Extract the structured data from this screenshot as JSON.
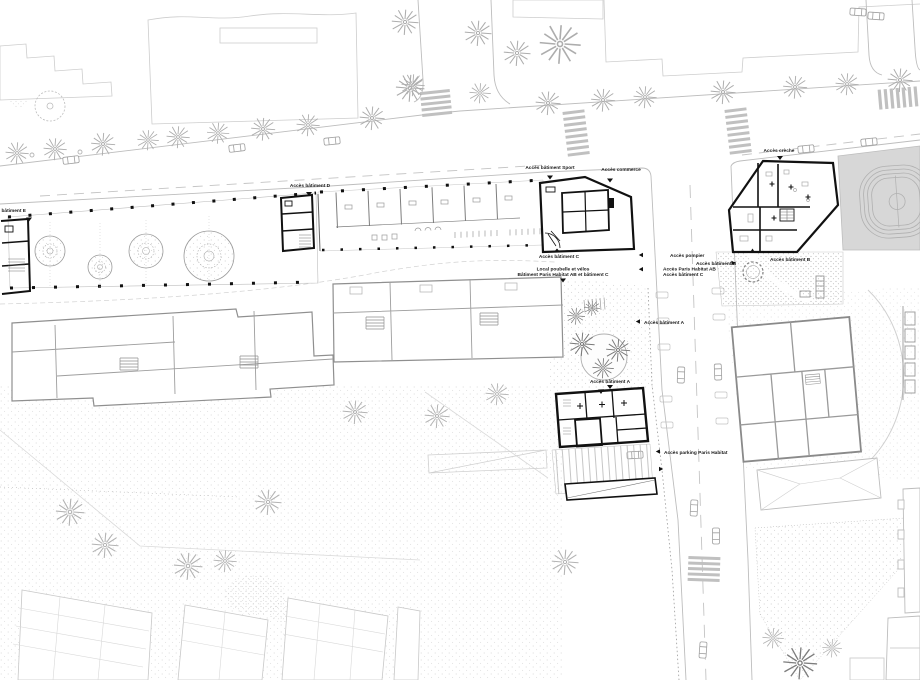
{
  "plan": {
    "labels": {
      "acces_batiment_e": "Accès bâtiment E",
      "acces_batiment_d": "Accès bâtiment D",
      "acces_batiment_sport": "Accès bâtiment Sport",
      "acces_commerce": "Accès commerce",
      "acces_creche": "Accès crèche",
      "acces_batiment_c_top": "Accès bâtiment C",
      "local_poubelle_l1": "Local poubelle et vélos",
      "local_poubelle_l2": "Bâtiment Paris Habitat AB et bâtiment C",
      "acces_pompier": "Accès pompier",
      "acces_paris_habitat_ab": "Accès Paris Habitat AB",
      "acces_batiment_c_right": "Accès bâtiment C",
      "acces_batiment_b_street": "Accès bâtiment B",
      "acces_batiment_b_court": "Accès bâtiment B",
      "acces_batiment_a_street": "Accès bâtiment A",
      "acces_batiment_a_court": "Accès bâtiment A",
      "acces_parking": "Accès parking Paris Habitat"
    }
  }
}
